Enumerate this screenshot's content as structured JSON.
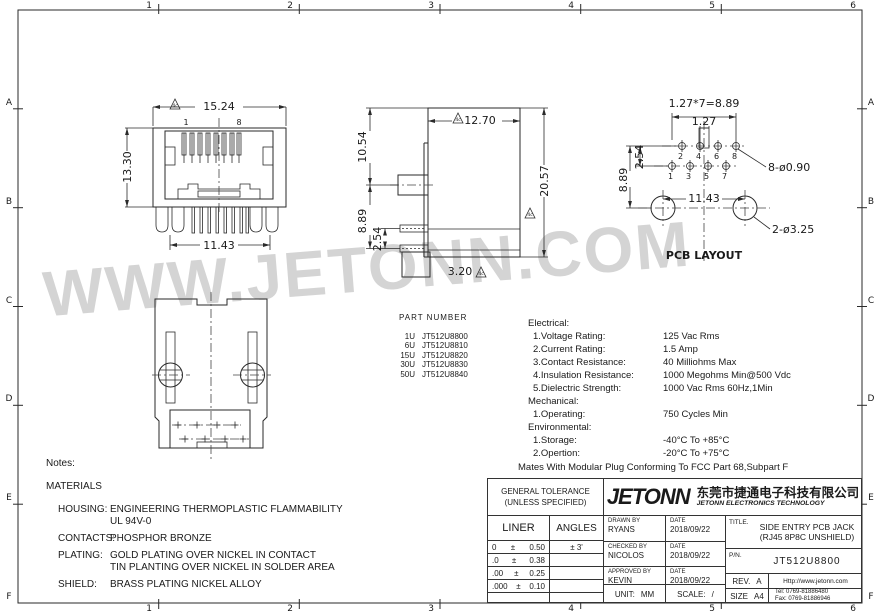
{
  "frame": {
    "cols": [
      "1",
      "2",
      "3",
      "4",
      "5",
      "6"
    ],
    "rows": [
      "A",
      "B",
      "C",
      "D",
      "E",
      "F"
    ]
  },
  "watermark": "WWW.JETONN.COM",
  "views": {
    "flag": "4c",
    "front": {
      "dim_width": "15.24",
      "dim_height": "13.30",
      "dim_bottom": "11.43",
      "pin_first": "1",
      "pin_last": "8"
    },
    "side": {
      "dim_top": "12.70",
      "dim_left_top": "10.54",
      "dim_left_a": "8.89",
      "dim_left_b": "2.54",
      "dim_right": "20.57",
      "dim_foot": "3.20"
    },
    "pcb": {
      "dim_pitch_total": "1.27*7=8.89",
      "dim_pitch": "1.27",
      "dim_left_a": "8.89",
      "dim_left_b": "2.54",
      "dim_holes": "11.43",
      "hole_small": "8-ø0.90",
      "hole_big": "2-ø3.25",
      "caption": "PCB LAYOUT",
      "pins_top": [
        "2",
        "4",
        "6",
        "8"
      ],
      "pins_bottom": [
        "1",
        "3",
        "5",
        "7"
      ]
    }
  },
  "part_numbers": {
    "title": "PART NUMBER",
    "items": [
      {
        "code": "1U",
        "pn": "JT512U8800"
      },
      {
        "code": "6U",
        "pn": "JT512U8810"
      },
      {
        "code": "15U",
        "pn": "JT512U8820"
      },
      {
        "code": "30U",
        "pn": "JT512U8830"
      },
      {
        "code": "50U",
        "pn": "JT512U8840"
      }
    ]
  },
  "specs": {
    "sections": [
      {
        "heading": "Electrical:",
        "items": [
          {
            "label": "1.Voltage Rating:",
            "value": "125 Vac Rms"
          },
          {
            "label": "2.Current Rating:",
            "value": "1.5 Amp"
          },
          {
            "label": "3.Contact Resistance:",
            "value": "40 Milliohms Max"
          },
          {
            "label": "4.Insulation Resistance:",
            "value": "1000 Megohms Min@500 Vdc"
          },
          {
            "label": "5.Dielectric Strength:",
            "value": "1000 Vac Rms 60Hz,1Min"
          }
        ]
      },
      {
        "heading": "Mechanical:",
        "items": [
          {
            "label": "1.Operating:",
            "value": "750 Cycles Min"
          }
        ]
      },
      {
        "heading": "Environmental:",
        "items": [
          {
            "label": "1.Storage:",
            "value": "-40°C To +85°C"
          },
          {
            "label": "2.Opertion:",
            "value": "-20°C To +75°C"
          }
        ]
      }
    ],
    "footer": "Mates With Modular Plug Conforming To FCC Part 68,Subpart F"
  },
  "notes": {
    "title": "Notes:",
    "subtitle": "MATERIALS",
    "rows": [
      {
        "term": "HOUSING:",
        "desc": [
          "ENGINEERING THERMOPLASTIC FLAMMABILITY",
          "UL 94V-0"
        ]
      },
      {
        "term": "CONTACTS:",
        "desc": [
          "PHOSPHOR BRONZE"
        ]
      },
      {
        "term": "PLATING:",
        "desc": [
          "GOLD PLATING OVER NICKEL IN CONTACT",
          "TIN PLANTING OVER NICKEL IN SOLDER AREA"
        ]
      },
      {
        "term": "SHIELD:",
        "desc": [
          "BRASS PLATING NICKEL ALLOY"
        ]
      }
    ]
  },
  "title_block": {
    "tolerance": {
      "header_line1": "GENERAL TOLERANCE",
      "header_line2": "(UNLESS SPECIFIED)",
      "col_liner": "LINER",
      "col_angles": "ANGLES",
      "rows": [
        {
          "l": "0",
          "s": "±",
          "r": "0.50",
          "angle": "±  3'"
        },
        {
          "l": ".0",
          "s": "±",
          "r": "0.38",
          "angle": ""
        },
        {
          "l": ".00",
          "s": "±",
          "r": "0.25",
          "angle": ""
        },
        {
          "l": ".000",
          "s": "±",
          "r": "0.10",
          "angle": ""
        }
      ]
    },
    "company": {
      "logo": "JETONN",
      "name_cn": "东莞市捷通电子科技有限公司",
      "name_en": "JETONN ELECTRONICS TECHNOLOGY"
    },
    "signoff": [
      {
        "role": "DRAWN BY",
        "name": "RYANS",
        "date_label": "DATE",
        "date": "2018/09/22"
      },
      {
        "role": "CHECKED BY",
        "name": "NICOLOS",
        "date_label": "DATE",
        "date": "2018/09/22"
      },
      {
        "role": "APPROVED BY",
        "name": "KEVIN",
        "date_label": "DATE",
        "date": "2018/09/22"
      }
    ],
    "unit_label": "UNIT:",
    "unit": "MM",
    "scale_label": "SCALE:",
    "scale": "/",
    "title_label": "TITLE.",
    "title_line1": "SIDE ENTRY PCB JACK",
    "title_line2": "(RJ45  8P8C UNSHIELD)",
    "pn_label": "P/N.",
    "pn": "JT512U8800",
    "rev_label": "REV.",
    "rev": "A",
    "size_label": "SIZE",
    "size": "A4",
    "url": "Http://www.jetonn.com",
    "tel": "Tel:  0769-81886480",
    "fax": "Fax:  0769-81886946"
  }
}
